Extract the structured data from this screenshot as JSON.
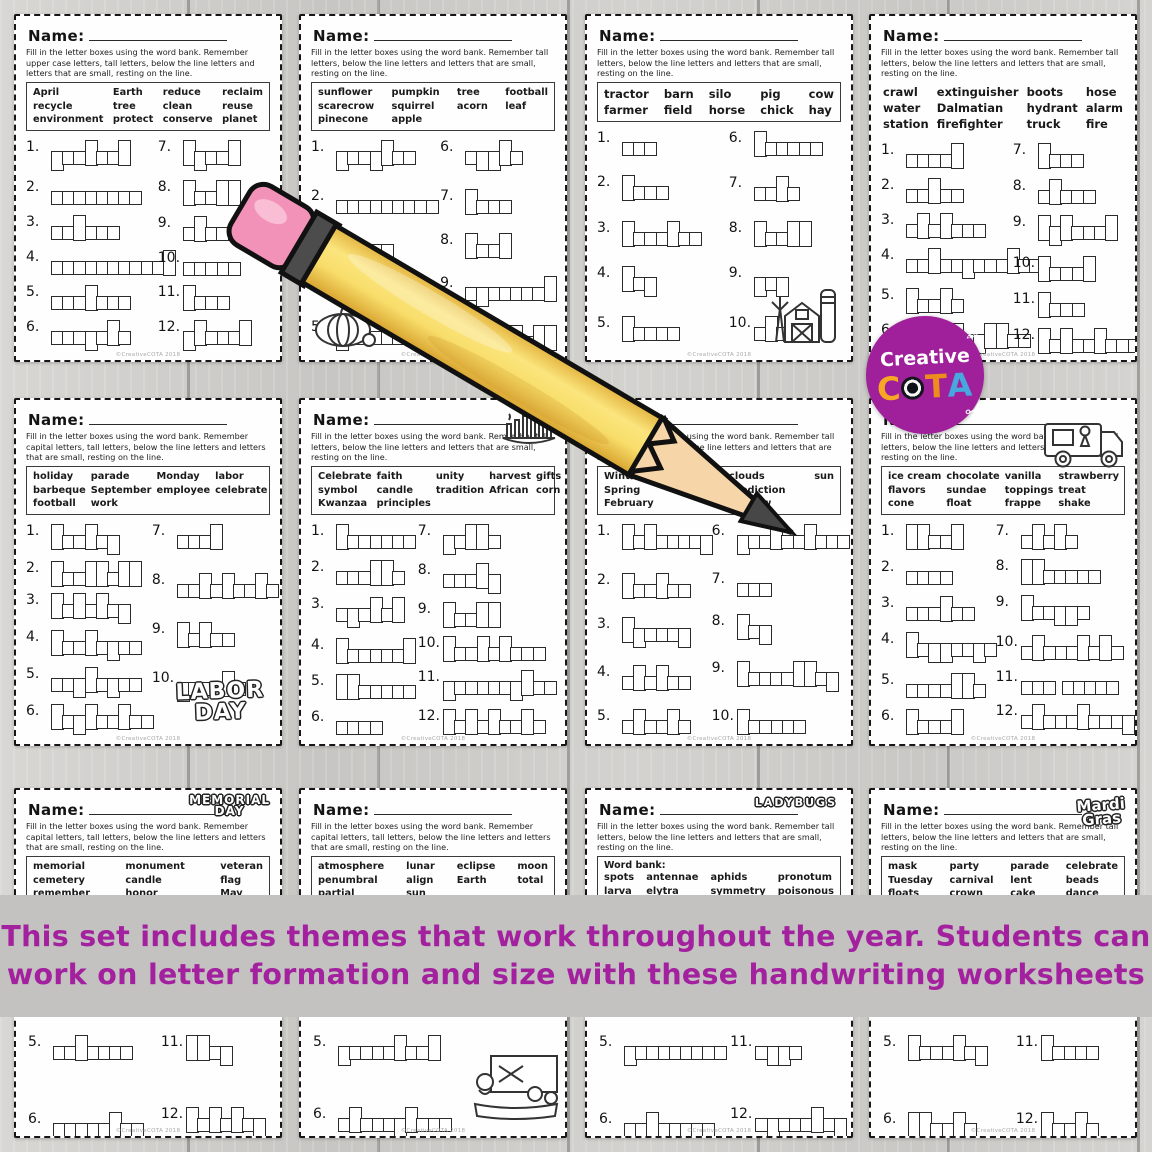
{
  "caption": {
    "line1": "This set includes themes that work throughout the year.  Students can",
    "line2": "work on letter formation and size with these handwriting worksheets",
    "color": "#a3219e",
    "bg": "#c3c2c1"
  },
  "logo": {
    "brand_line": "Creative",
    "letters": [
      "C",
      "O",
      "T",
      "A"
    ],
    "letter_colors": [
      "#f6a823",
      "#14141c",
      "#ee8c1e",
      "#47a7df"
    ],
    "circle_color": "#a0209b",
    "scissors_icon": "✂",
    "pencil_icon": "✎"
  },
  "copyright": "©CreativeCOTA 2018",
  "worksheets": [
    {
      "theme": "earth-day",
      "name_label": "Name:",
      "instructions": "Fill in the letter boxes using the word bank.  Remember upper case letters, tall letters, below the line letters and letters that are small, resting on the line.",
      "bank_label": "",
      "bank_cols": 4,
      "bank_border": true,
      "bank_size": "sm",
      "bank_rows": [
        [
          "April",
          "Earth",
          "reduce",
          "reclaim"
        ],
        [
          "recycle",
          "tree",
          "clean",
          "reuse"
        ],
        [
          "environment",
          "protect",
          "conserve",
          "planet"
        ]
      ],
      "left_count": 6,
      "items": [
        [
          1,
          "protect"
        ],
        [
          2,
          "conserve"
        ],
        [
          3,
          "reduce"
        ],
        [
          4,
          "environment"
        ],
        [
          5,
          "reclaim"
        ],
        [
          6,
          "recycle"
        ],
        [
          7,
          "April"
        ],
        [
          8,
          "Earth"
        ],
        [
          9,
          "clean"
        ],
        [
          10,
          "reuse"
        ],
        [
          11,
          "tree"
        ],
        [
          12,
          "planet"
        ]
      ],
      "clipart": null
    },
    {
      "theme": "fall",
      "name_label": "Name:",
      "instructions": "Fill in the letter boxes using the word bank.  Remember tall letters, below the line letters and letters that are small, resting on the line.",
      "bank_label": "",
      "bank_cols": 4,
      "bank_border": true,
      "bank_size": "sm",
      "bank_rows": [
        [
          "sunflower",
          "pumpkin",
          "tree",
          "football"
        ],
        [
          "scarecrow",
          "squirrel",
          "acorn",
          "leaf"
        ],
        [
          "pinecone",
          "apple",
          "",
          ""
        ]
      ],
      "left_count": 5,
      "items": [
        [
          1,
          "pumpkin"
        ],
        [
          2,
          "scarecrow"
        ],
        [
          3,
          "acorn"
        ],
        [
          4,
          "sunflower"
        ],
        [
          5,
          "pinecone"
        ],
        [
          6,
          "apple"
        ],
        [
          7,
          "tree"
        ],
        [
          8,
          "leaf"
        ],
        [
          9,
          "squirrel"
        ],
        [
          10,
          "football"
        ]
      ],
      "clipart": {
        "kind": "pumpkin",
        "name": "pumpkin-clipart"
      }
    },
    {
      "theme": "farm",
      "name_label": "Name:",
      "instructions": "Fill in the letter boxes using the word bank.  Remember tall letters, below the line letters and letters that are small, resting on the line.",
      "bank_label": "",
      "bank_cols": 5,
      "bank_border": true,
      "bank_size": "lg",
      "bank_rows": [
        [
          "tractor",
          "barn",
          "silo",
          "pig",
          "cow"
        ],
        [
          "farmer",
          "field",
          "horse",
          "chick",
          "hay"
        ]
      ],
      "left_count": 5,
      "items": [
        [
          1,
          "cow"
        ],
        [
          2,
          "barn"
        ],
        [
          3,
          "tractor"
        ],
        [
          4,
          "hay"
        ],
        [
          5,
          "horse"
        ],
        [
          6,
          "farmer"
        ],
        [
          7,
          "silo"
        ],
        [
          8,
          "field"
        ],
        [
          9,
          "pig"
        ],
        [
          10,
          "chick"
        ]
      ],
      "clipart": {
        "kind": "barn",
        "name": "barn-clipart"
      }
    },
    {
      "theme": "fire-safety",
      "name_label": "Name:",
      "instructions": "Fill in the letter boxes using the word bank.  Remember tall letters, below the line letters and letters that are small, resting on the line.",
      "bank_label": "",
      "bank_cols": 4,
      "bank_border": false,
      "bank_size": "lg",
      "bank_rows": [
        [
          "crawl",
          "extinguisher",
          "boots",
          "hose"
        ],
        [
          "water",
          "Dalmatian",
          "hydrant",
          "alarm"
        ],
        [
          "station",
          "firefighter",
          "truck",
          "fire"
        ]
      ],
      "left_count": 6,
      "items": [
        [
          1,
          "crawl"
        ],
        [
          2,
          "water"
        ],
        [
          3,
          "station"
        ],
        [
          4,
          "extinguisher"
        ],
        [
          5,
          "boots"
        ],
        [
          6,
          "firefighter"
        ],
        [
          7,
          "hose"
        ],
        [
          8,
          "alarm"
        ],
        [
          9,
          "hydrant"
        ],
        [
          10,
          "truck"
        ],
        [
          11,
          "fire"
        ],
        [
          12,
          "Dalmatian"
        ]
      ],
      "clipart": null
    },
    {
      "theme": "labor-day",
      "name_label": "Name:",
      "instructions": "Fill in the letter boxes using the word bank.  Remember capital letters, tall letters, below the line letters and letters that are small, resting on the line.",
      "bank_label": "",
      "bank_cols": 4,
      "bank_border": true,
      "bank_size": "sm",
      "bank_rows": [
        [
          "holiday",
          "parade",
          "Monday",
          "labor"
        ],
        [
          "barbeque",
          "September",
          "employee",
          "celebrate"
        ],
        [
          "football",
          "work",
          "",
          ""
        ]
      ],
      "left_count": 6,
      "items": [
        [
          1,
          "Monday"
        ],
        [
          2,
          "football"
        ],
        [
          3,
          "holiday"
        ],
        [
          4,
          "barbeque"
        ],
        [
          5,
          "employee"
        ],
        [
          6,
          "September"
        ],
        [
          7,
          "work"
        ],
        [
          8,
          "celebrate"
        ],
        [
          9,
          "labor"
        ],
        [
          10,
          "parade"
        ]
      ],
      "clipart": {
        "kind": "bubble",
        "name": "labor-day-bubble-art",
        "lines": [
          "LABOR",
          "DAY"
        ]
      }
    },
    {
      "theme": "kwanzaa",
      "name_label": "Name:",
      "instructions": "Fill in the letter boxes using the word bank.  Remember tall letters, below the line letters and letters that are small, resting on the line.",
      "bank_label": "",
      "bank_cols": 5,
      "bank_border": true,
      "bank_size": "sm",
      "bank_rows": [
        [
          "Celebrate",
          "faith",
          "unity",
          "harvest",
          "gifts"
        ],
        [
          "symbol",
          "candle",
          "tradition",
          "African",
          "corn"
        ],
        [
          "Kwanzaa",
          "principles",
          "",
          "",
          ""
        ]
      ],
      "left_count": 6,
      "items": [
        [
          1,
          "Kwanzaa"
        ],
        [
          2,
          "candle"
        ],
        [
          3,
          "symbol"
        ],
        [
          4,
          "harvest"
        ],
        [
          5,
          "African"
        ],
        [
          6,
          "corn"
        ],
        [
          7,
          "gifts"
        ],
        [
          8,
          "unity"
        ],
        [
          9,
          "faith"
        ],
        [
          10,
          "tradition"
        ],
        [
          11,
          "principles"
        ],
        [
          12,
          "Celebrate"
        ]
      ],
      "clipart": {
        "kind": "kinara",
        "name": "kinara-clipart"
      }
    },
    {
      "theme": "groundhog-day",
      "name_label": "Name:",
      "instructions": "Fill in the letter boxes using the word bank.  Remember tall letters, capitals, below the line letters and letters that are small, resting on the line.",
      "bank_label": "",
      "bank_cols": 4,
      "bank_border": true,
      "bank_size": "sm",
      "bank_rows": [
        [
          "Winter",
          "fog",
          "clouds",
          "sun"
        ],
        [
          "Spring",
          "",
          "prediction",
          ""
        ],
        [
          "February",
          "",
          "shadow",
          ""
        ]
      ],
      "left_count": 5,
      "items": [
        [
          1,
          "February"
        ],
        [
          2,
          "Winter"
        ],
        [
          3,
          "Spring"
        ],
        [
          4,
          "shadow"
        ],
        [
          5,
          "clouds"
        ],
        [
          6,
          "prediction"
        ],
        [
          7,
          "sun"
        ],
        [
          8,
          "fog"
        ],
        [
          9,
          "Groundhog"
        ],
        [
          10,
          "burrow"
        ]
      ],
      "clipart": null
    },
    {
      "theme": "ice-cream",
      "name_label": "Name:",
      "instructions": "Fill in the letter boxes using the word bank.  Remember tall letters, below the line letters and letters that are small, resting on the line.",
      "bank_label": "",
      "bank_cols": 4,
      "bank_border": true,
      "bank_size": "sm",
      "bank_rows": [
        [
          "ice cream",
          "chocolate",
          "vanilla",
          "strawberry"
        ],
        [
          "flavors",
          "sundae",
          "toppings",
          "treat"
        ],
        [
          "cone",
          "float",
          "frappe",
          "shake"
        ]
      ],
      "left_count": 6,
      "items": [
        [
          1,
          "float"
        ],
        [
          2,
          "cone"
        ],
        [
          3,
          "sundae"
        ],
        [
          4,
          "toppings"
        ],
        [
          5,
          "vanilla"
        ],
        [
          6,
          "treat"
        ],
        [
          7,
          "shake"
        ],
        [
          8,
          "flavors"
        ],
        [
          9,
          "frappe"
        ],
        [
          10,
          "chocolate"
        ],
        [
          11,
          "ice cream"
        ],
        [
          12,
          "strawberry"
        ]
      ],
      "clipart": {
        "kind": "truck",
        "name": "ice-cream-truck-clipart"
      }
    },
    {
      "theme": "memorial-day",
      "name_label": "Name:",
      "instructions": "Fill in the letter boxes using the word bank.  Remember capital letters, tall letters, below the line letters and letters that are small, resting on the line.",
      "bank_label": "",
      "bank_cols": 3,
      "bank_border": true,
      "bank_size": "sm",
      "bank_rows": [
        [
          "memorial",
          "monument",
          "veteran"
        ],
        [
          "cemetery",
          "candle",
          "flag"
        ],
        [
          "remember",
          "honor",
          "May"
        ],
        [
          "military",
          "service",
          "holiday"
        ]
      ],
      "left_count": 6,
      "items": [
        [
          5,
          "veteran"
        ],
        [
          6,
          "remember"
        ],
        [
          11,
          "flag"
        ],
        [
          12,
          "holiday"
        ]
      ],
      "clipart": {
        "kind": "bubble",
        "name": "memorial-day-bubble-art",
        "lines": [
          "MEMORIAL",
          "DAY"
        ]
      }
    },
    {
      "theme": "eclipse",
      "name_label": "Name:",
      "instructions": "Fill in the letter boxes using the word bank.  Remember capital letters, tall letters, below the line letters and letters that are small, resting on the line.",
      "bank_label": "",
      "bank_cols": 4,
      "bank_border": true,
      "bank_size": "sm",
      "bank_rows": [
        [
          "atmosphere",
          "lunar",
          "eclipse",
          "moon"
        ],
        [
          "penumbral",
          "align",
          "Earth",
          "total"
        ],
        [
          "partial",
          "sun",
          "",
          ""
        ]
      ],
      "left_count": 6,
      "items": [
        [
          5,
          "penumbral"
        ],
        [
          6,
          "atmosphere"
        ]
      ],
      "clipart": {
        "kind": "classroom",
        "name": "classroom-clipart"
      }
    },
    {
      "theme": "ladybugs",
      "name_label": "Name:",
      "instructions": "Fill in the letter boxes using the word bank.  Remember tall letters, below the line letters and letters that are small, resting on the line.",
      "bank_label": "Word bank:",
      "bank_cols": 4,
      "bank_border": true,
      "bank_size": "sm",
      "bank_rows": [
        [
          "spots",
          "antennae",
          "aphids",
          "pronotum"
        ],
        [
          "larva",
          "elytra",
          "symmetry",
          "poisonous"
        ],
        [
          "pupa",
          "eggs",
          "wings",
          "colorful"
        ]
      ],
      "left_count": 6,
      "items": [
        [
          5,
          "poisonous"
        ],
        [
          6,
          "antennae"
        ],
        [
          11,
          "eggs"
        ],
        [
          12,
          "symmetry"
        ]
      ],
      "clipart": {
        "kind": "bubble",
        "name": "ladybugs-bubble-art",
        "lines": [
          "LADYBUGS"
        ]
      }
    },
    {
      "theme": "mardi-gras",
      "name_label": "Name:",
      "instructions": "Fill in the letter boxes using the word bank.  Remember tall letters, below the line letters and letters that are small, resting on the line.",
      "bank_label": "",
      "bank_cols": 4,
      "bank_border": true,
      "bank_size": "sm",
      "bank_rows": [
        [
          "mask",
          "party",
          "parade",
          "celebrate"
        ],
        [
          "Tuesday",
          "carnival",
          "lent",
          "beads"
        ],
        [
          "floats",
          "crown",
          "cake",
          "dance"
        ]
      ],
      "left_count": 6,
      "items": [
        [
          5,
          "Tuesday"
        ],
        [
          6,
          "floats"
        ],
        [
          11,
          "dance"
        ],
        [
          12,
          "beads"
        ]
      ],
      "clipart": {
        "kind": "bubble",
        "name": "mardi-gras-bubble-art",
        "lines": [
          "Mardi",
          "Gras"
        ]
      }
    }
  ]
}
